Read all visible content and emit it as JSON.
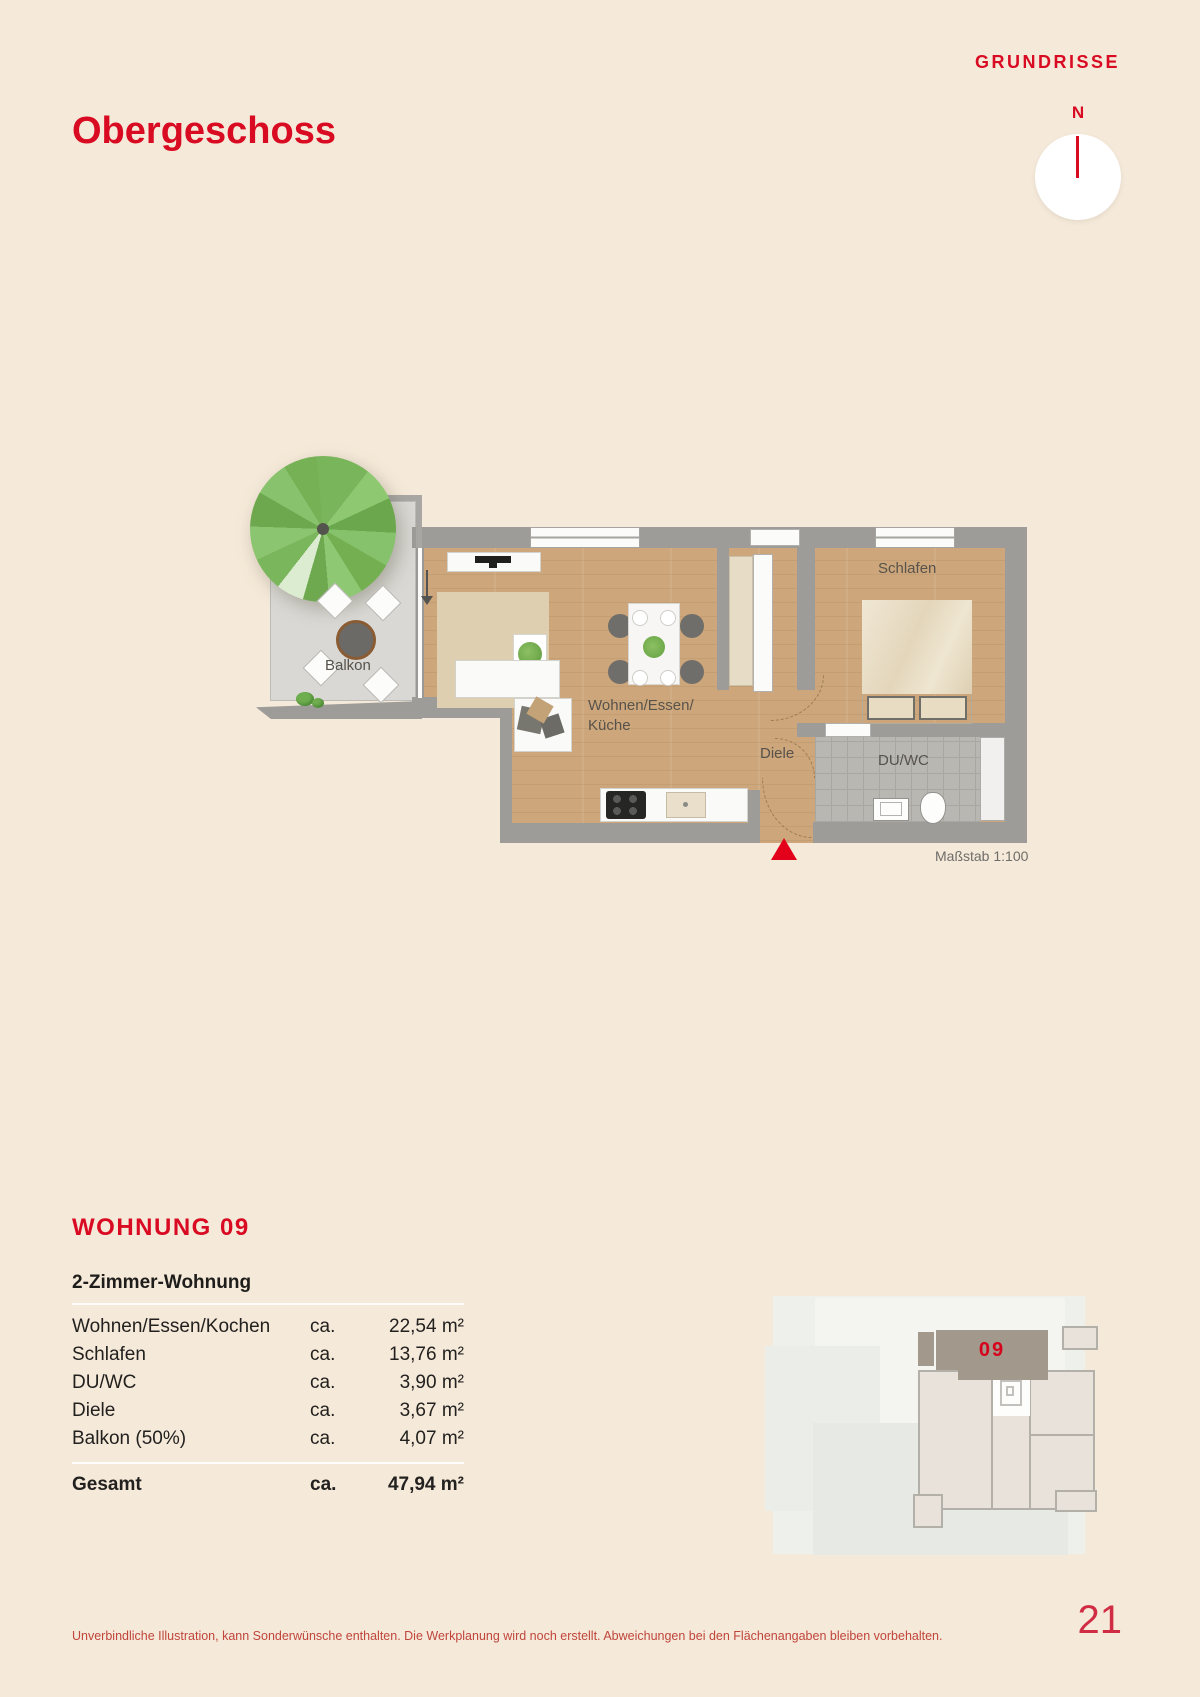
{
  "page": {
    "kicker": "GRUNDRISSE",
    "title": "Obergeschoss",
    "footer_note": "Unverbindliche Illustration, kann Sonderwünsche enthalten. Die Werkplanung wird noch erstellt. Abweichungen bei den Flächenangaben bleiben vorbehalten.",
    "page_number": "21"
  },
  "compass": {
    "north_label": "N"
  },
  "floorplan": {
    "labels": {
      "balkon": "Balkon",
      "wohnen_line1": "Wohnen/Essen/",
      "wohnen_line2": "Küche",
      "diele": "Diele",
      "schlafen": "Schlafen",
      "du_wc": "DU/WC"
    },
    "scale_label": "Maßstab 1:100"
  },
  "apartment": {
    "heading": "WOHNUNG 09",
    "subtitle": "2-Zimmer-Wohnung",
    "rows": [
      {
        "label": "Wohnen/Essen/Kochen",
        "prefix": "ca.",
        "value": "22,54 m²"
      },
      {
        "label": "Schlafen",
        "prefix": "ca.",
        "value": "13,76 m²"
      },
      {
        "label": "DU/WC",
        "prefix": "ca.",
        "value": "3,90 m²"
      },
      {
        "label": "Diele",
        "prefix": "ca.",
        "value": "3,67 m²"
      },
      {
        "label": "Balkon (50%)",
        "prefix": "ca.",
        "value": "4,07 m²"
      }
    ],
    "total": {
      "label": "Gesamt",
      "prefix": "ca.",
      "value": "47,94 m²"
    }
  },
  "minimap": {
    "unit_label": "09"
  },
  "colors": {
    "accent_red": "#d90b22",
    "entrance_marker_red": "#e2001a",
    "background_cream": "#f5e9d9",
    "wood_floor": "#cda77b",
    "wall_gray": "#9d9c98",
    "unit_highlight": "#a2988b"
  }
}
